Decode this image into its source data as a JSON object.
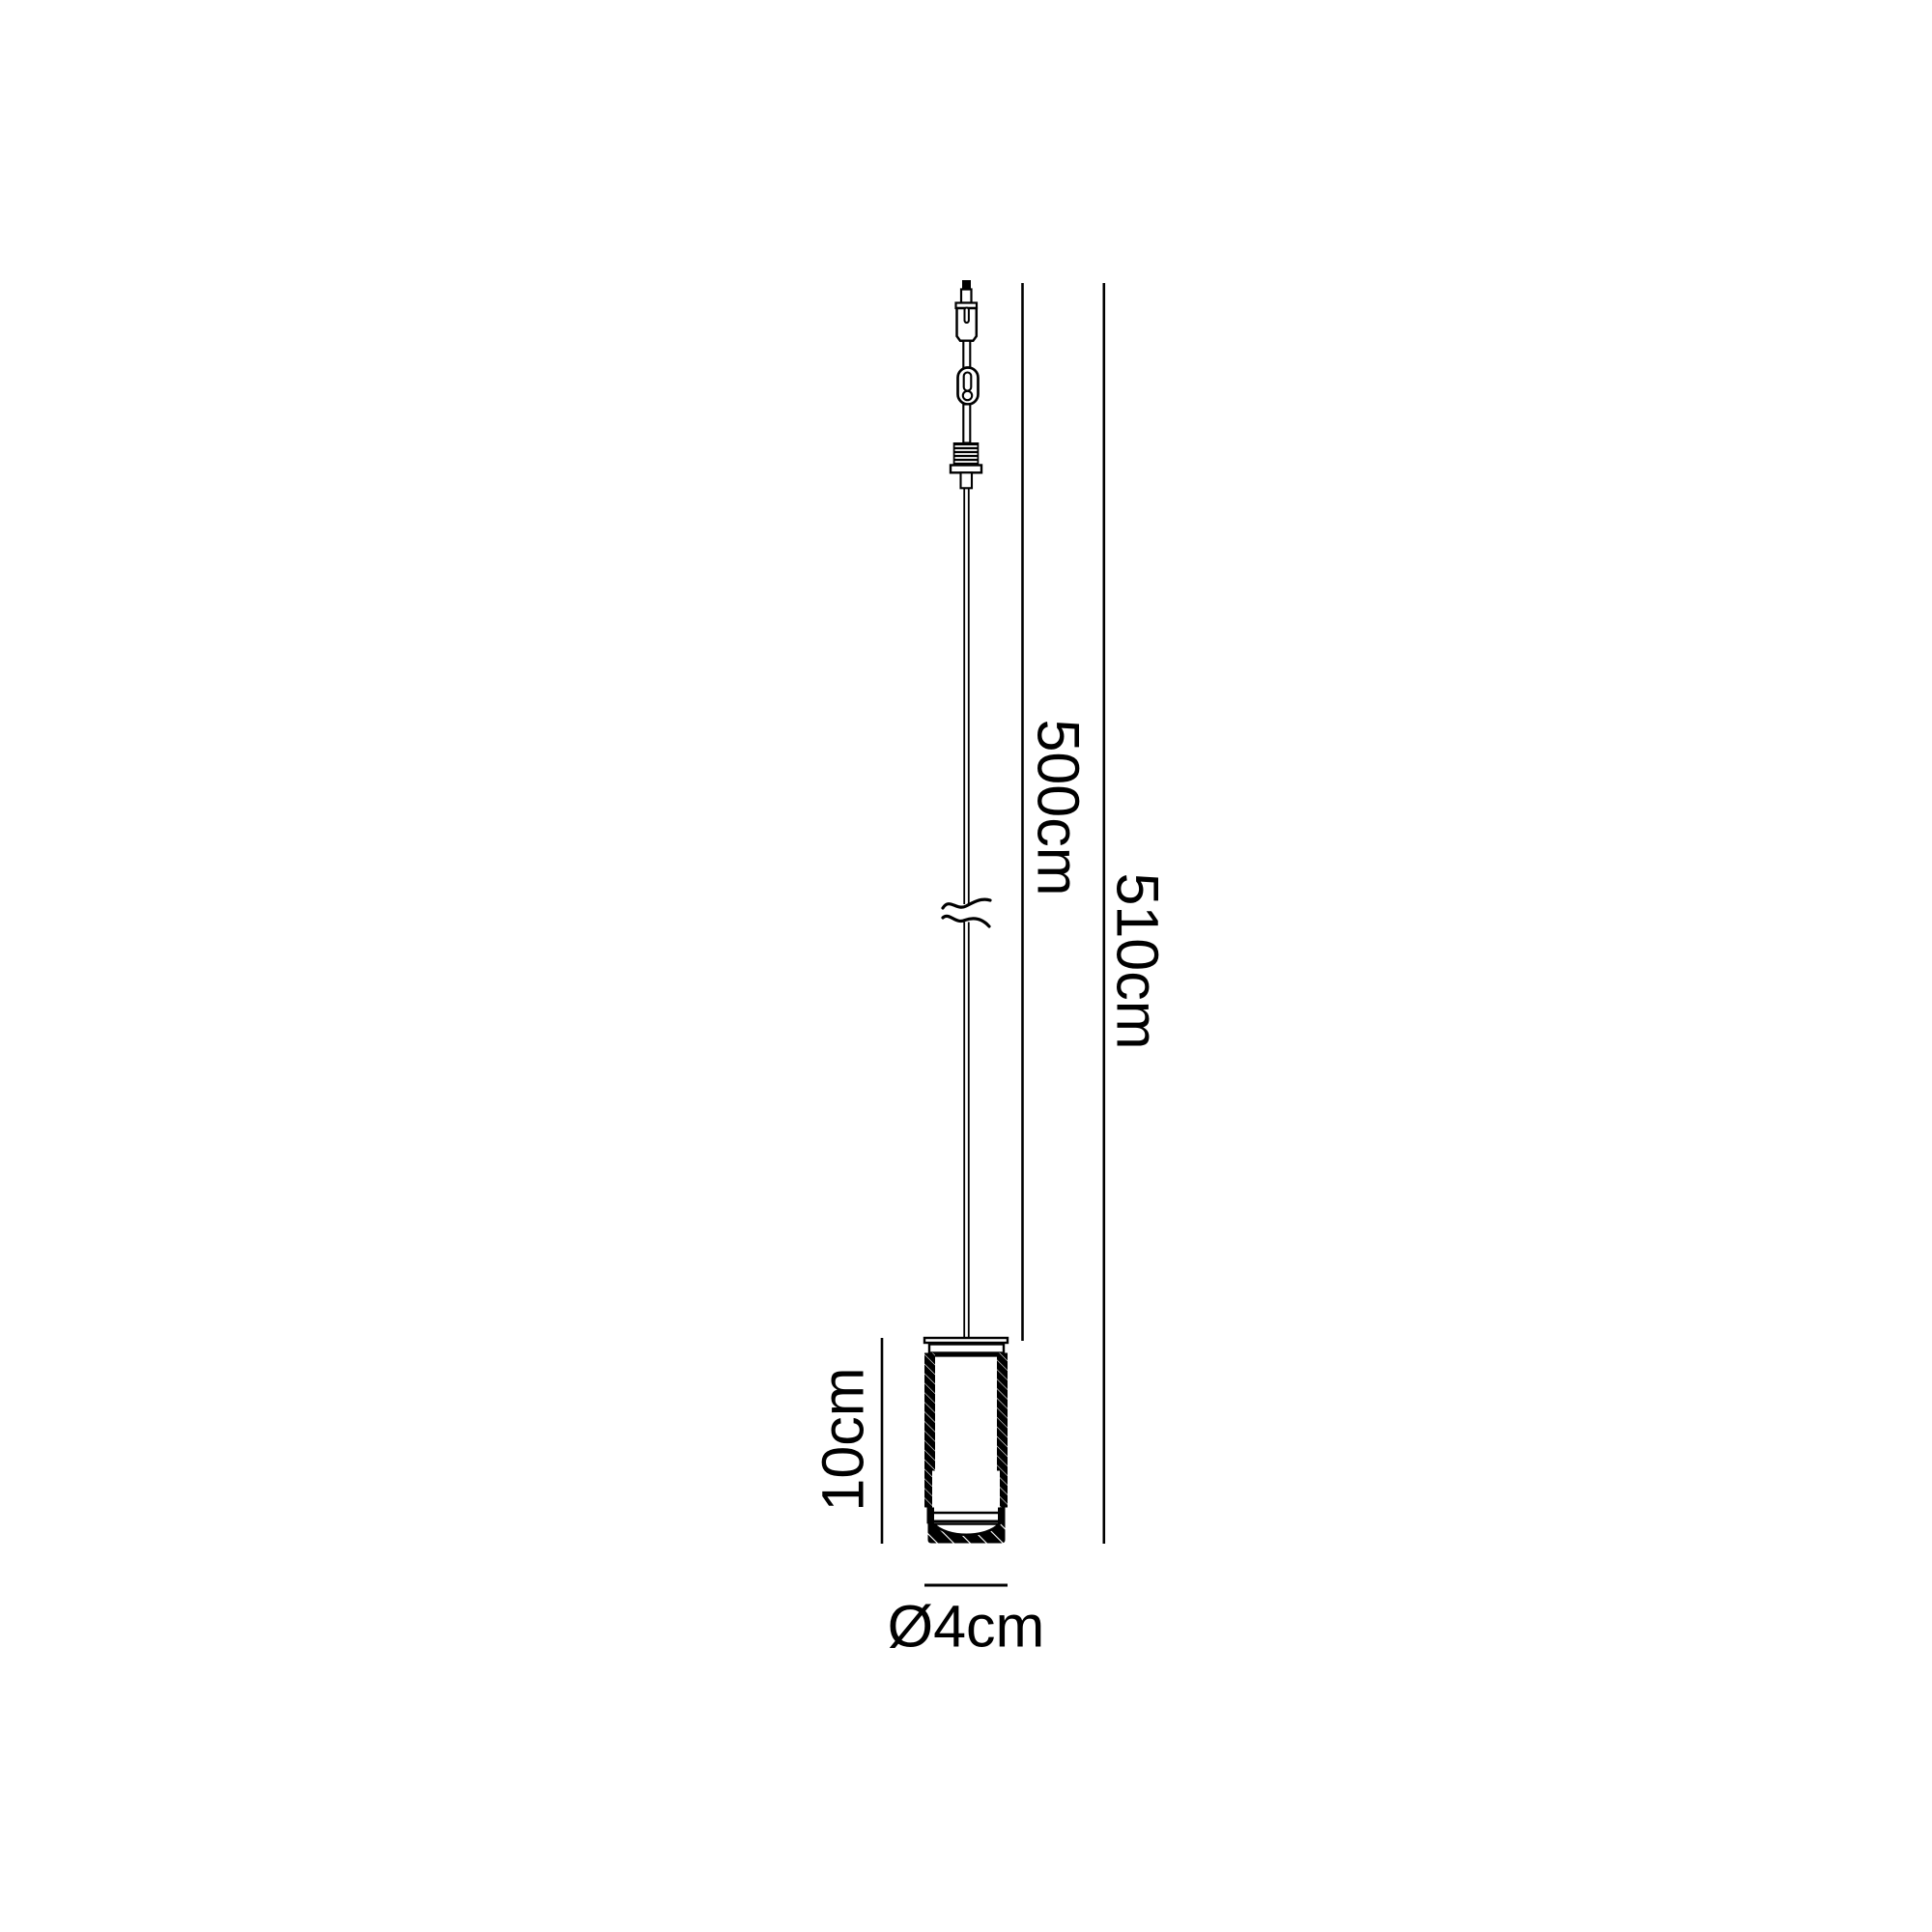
{
  "canvas": {
    "background": "#ffffff",
    "ink": "#000000"
  },
  "diagram": {
    "kind": "pendant-light-dimension-drawing",
    "labels": {
      "cable_length": "500cm",
      "overall_height": "510cm",
      "shade_height": "10cm",
      "shade_diameter": "Ø4cm"
    },
    "parts": [
      "cord-grip-nub",
      "canopy-cylinder",
      "chain-link-connector",
      "threaded-nipple",
      "flange-plate",
      "suspension-cable",
      "cable-break-symbol",
      "cylinder-shade"
    ]
  }
}
